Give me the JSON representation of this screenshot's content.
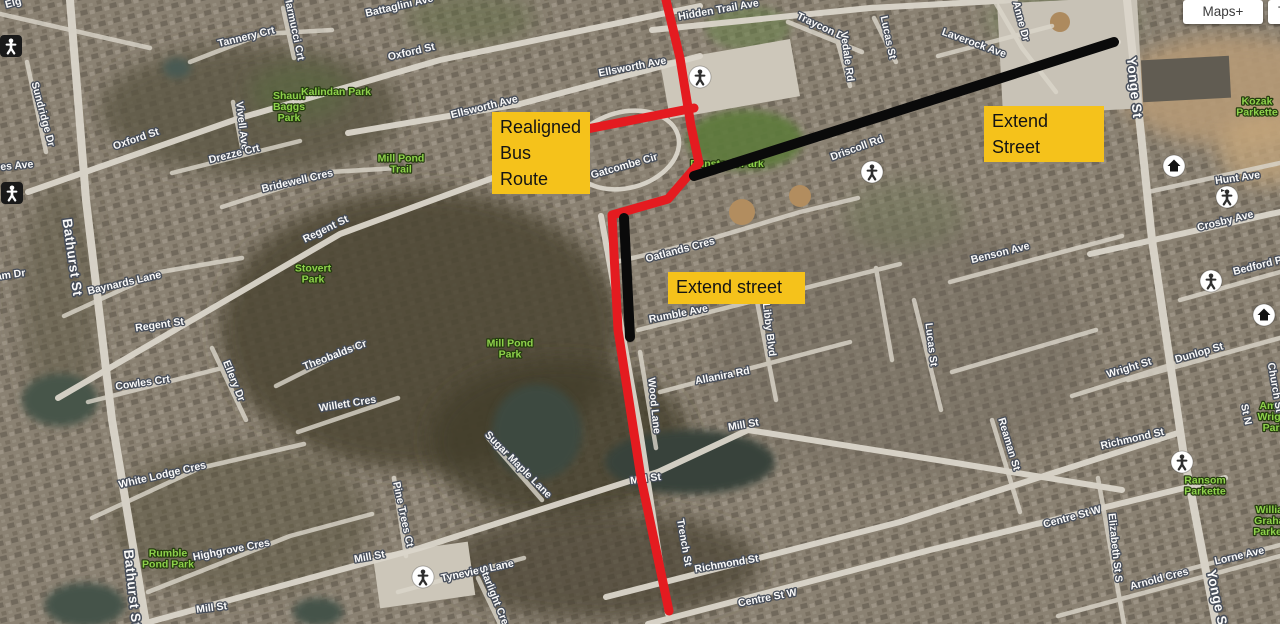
{
  "toolbar": {
    "maps_label": "Maps+",
    "tools_label": "To"
  },
  "annotations": {
    "box_color": "#f5c21b",
    "routes": [
      {
        "name": "realigned-bus-route-line",
        "color": "#e41b20",
        "width": 9,
        "points": [
          [
            666,
            0
          ],
          [
            680,
            58
          ],
          [
            691,
            126
          ],
          [
            699,
            163
          ],
          [
            668,
            199
          ],
          [
            612,
            215
          ],
          [
            618,
            330
          ],
          [
            641,
            478
          ],
          [
            669,
            611
          ]
        ]
      },
      {
        "name": "realigned-bus-route-spur",
        "color": "#e41b20",
        "width": 9,
        "points": [
          [
            587,
            129
          ],
          [
            694,
            108
          ]
        ]
      },
      {
        "name": "extend-street-line-east",
        "color": "#0a0a0a",
        "width": 10,
        "points": [
          [
            694,
            176
          ],
          [
            1114,
            42
          ]
        ]
      },
      {
        "name": "extend-street-line-south",
        "color": "#0a0a0a",
        "width": 10,
        "points": [
          [
            624,
            218
          ],
          [
            630,
            337
          ]
        ]
      }
    ],
    "boxes": [
      {
        "name": "realigned-bus-route-label",
        "text": "Realigned\nBus Route",
        "x": 492,
        "y": 112,
        "w": 98,
        "h": 54
      },
      {
        "name": "extend-street-label-north",
        "text": "Extend Street",
        "x": 984,
        "y": 106,
        "w": 120,
        "h": 31
      },
      {
        "name": "extend-street-label-south",
        "text": "Extend street",
        "x": 668,
        "y": 272,
        "w": 137,
        "h": 32
      }
    ]
  },
  "map": {
    "labels": [
      {
        "name": "label-elg-fragment",
        "text": "Elg",
        "x": 14,
        "y": 6,
        "rot": -15,
        "kind": "street"
      },
      {
        "name": "label-battaglini-ave",
        "text": "Battaglini Ave",
        "x": 400,
        "y": 9,
        "rot": -13,
        "kind": "street"
      },
      {
        "name": "label-tannery-crt",
        "text": "Tannery Crt",
        "x": 247,
        "y": 40,
        "rot": -14,
        "kind": "street"
      },
      {
        "name": "label-marmucci-crt",
        "text": "Marmucci Crt",
        "x": 291,
        "y": 28,
        "rot": 78,
        "kind": "street"
      },
      {
        "name": "label-oxford-st-west",
        "text": "Oxford St",
        "x": 137,
        "y": 142,
        "rot": -19,
        "kind": "street"
      },
      {
        "name": "label-oxford-st-east",
        "text": "Oxford St",
        "x": 412,
        "y": 55,
        "rot": -13,
        "kind": "street"
      },
      {
        "name": "label-sundridge-dr",
        "text": "Sundridge Dr",
        "x": 40,
        "y": 115,
        "rot": 75,
        "kind": "street"
      },
      {
        "name": "label-res-ave-fragment",
        "text": "res Ave",
        "x": 15,
        "y": 169,
        "rot": -5,
        "kind": "street"
      },
      {
        "name": "label-bathurst-st-north",
        "text": "Bathurst St",
        "x": 68,
        "y": 258,
        "rot": 82,
        "kind": "big"
      },
      {
        "name": "label-bathurst-st-south",
        "text": "Bathurst St",
        "x": 128,
        "y": 589,
        "rot": 84,
        "kind": "big"
      },
      {
        "name": "label-am-dr-fragment",
        "text": "am Dr",
        "x": 11,
        "y": 278,
        "rot": -8,
        "kind": "street"
      },
      {
        "name": "label-vivell-ave",
        "text": "Vivell Ave",
        "x": 239,
        "y": 126,
        "rot": 83,
        "kind": "street"
      },
      {
        "name": "label-drezze-crt",
        "text": "Drezze Crt",
        "x": 235,
        "y": 157,
        "rot": -14,
        "kind": "street"
      },
      {
        "name": "label-bridewell-cres",
        "text": "Bridewell Cres",
        "x": 298,
        "y": 184,
        "rot": -13,
        "kind": "street"
      },
      {
        "name": "label-shaun-baggs-park",
        "text": "Shaun\nBaggs\nPark",
        "x": 289,
        "y": 110,
        "rot": 0,
        "kind": "park"
      },
      {
        "name": "label-kalindan-park",
        "text": "Kalindan Park",
        "x": 336,
        "y": 95,
        "rot": 0,
        "kind": "park"
      },
      {
        "name": "label-mill-pond-trail",
        "text": "Mill Pond\nTrail",
        "x": 401,
        "y": 167,
        "rot": 0,
        "kind": "park"
      },
      {
        "name": "label-ellsworth-ave-east",
        "text": "Ellsworth Ave",
        "x": 633,
        "y": 70,
        "rot": -11,
        "kind": "street"
      },
      {
        "name": "label-ellsworth-ave-west",
        "text": "Ellsworth Ave",
        "x": 485,
        "y": 110,
        "rot": -14,
        "kind": "street"
      },
      {
        "name": "label-hidden-trail-ave",
        "text": "Hidden Trail Ave",
        "x": 719,
        "y": 13,
        "rot": -10,
        "kind": "street"
      },
      {
        "name": "label-traycon-dr",
        "text": "Traycon Dr",
        "x": 821,
        "y": 30,
        "rot": 25,
        "kind": "street"
      },
      {
        "name": "label-vedale-rd",
        "text": "Vedale Rd",
        "x": 844,
        "y": 57,
        "rot": 82,
        "kind": "street"
      },
      {
        "name": "label-lucas-st-north",
        "text": "Lucas St",
        "x": 885,
        "y": 38,
        "rot": 78,
        "kind": "street"
      },
      {
        "name": "label-laverock-ave",
        "text": "Laverock Ave",
        "x": 973,
        "y": 46,
        "rot": 20,
        "kind": "street"
      },
      {
        "name": "label-anne-dr",
        "text": "Anne Dr",
        "x": 1018,
        "y": 22,
        "rot": 75,
        "kind": "street"
      },
      {
        "name": "label-yonge-st-north",
        "text": "Yonge St",
        "x": 1130,
        "y": 88,
        "rot": 84,
        "kind": "big"
      },
      {
        "name": "label-yonge-st-south",
        "text": "Yonge St",
        "x": 1213,
        "y": 601,
        "rot": 78,
        "kind": "big"
      },
      {
        "name": "label-kozak-parkette",
        "text": "Kozak\nParkette",
        "x": 1257,
        "y": 110,
        "rot": 0,
        "kind": "park"
      },
      {
        "name": "label-hunt-ave",
        "text": "Hunt Ave",
        "x": 1238,
        "y": 181,
        "rot": -8,
        "kind": "street"
      },
      {
        "name": "label-crosby-ave",
        "text": "Crosby Ave",
        "x": 1226,
        "y": 224,
        "rot": -14,
        "kind": "street"
      },
      {
        "name": "label-bedford-park",
        "text": "Bedford Park",
        "x": 1266,
        "y": 267,
        "rot": -14,
        "kind": "street"
      },
      {
        "name": "label-benson-ave",
        "text": "Benson Ave",
        "x": 1001,
        "y": 256,
        "rot": -14,
        "kind": "street"
      },
      {
        "name": "label-driscoll-rd",
        "text": "Driscoll Rd",
        "x": 858,
        "y": 151,
        "rot": -20,
        "kind": "street"
      },
      {
        "name": "label-gatcombe-cir",
        "text": "Gatcombe Cir",
        "x": 625,
        "y": 169,
        "rot": -16,
        "kind": "street"
      },
      {
        "name": "label-dunstock-park",
        "text": "Dunstock Park",
        "x": 727,
        "y": 167,
        "rot": 0,
        "kind": "park"
      },
      {
        "name": "label-oatlands-cres",
        "text": "Oatlands Cres",
        "x": 681,
        "y": 253,
        "rot": -15,
        "kind": "street"
      },
      {
        "name": "label-rumble-ave",
        "text": "Rumble Ave",
        "x": 679,
        "y": 317,
        "rot": -11,
        "kind": "street"
      },
      {
        "name": "label-allanira-rd",
        "text": "Allanira Rd",
        "x": 723,
        "y": 379,
        "rot": -11,
        "kind": "street"
      },
      {
        "name": "label-libby-blvd",
        "text": "Libby Blvd",
        "x": 766,
        "y": 330,
        "rot": 83,
        "kind": "street"
      },
      {
        "name": "label-lucas-st-south",
        "text": "Lucas St",
        "x": 928,
        "y": 345,
        "rot": 83,
        "kind": "street"
      },
      {
        "name": "label-mill-st-center",
        "text": "Mill St",
        "x": 744,
        "y": 428,
        "rot": -10,
        "kind": "street"
      },
      {
        "name": "label-mill-st-west",
        "text": "Mill St",
        "x": 370,
        "y": 560,
        "rot": -10,
        "kind": "street"
      },
      {
        "name": "label-mill-st-southwest",
        "text": "Mill St",
        "x": 212,
        "y": 611,
        "rot": -7,
        "kind": "street"
      },
      {
        "name": "label-mill-st-pond",
        "text": "Mill St",
        "x": 646,
        "y": 482,
        "rot": -8,
        "kind": "street"
      },
      {
        "name": "label-wood-lane",
        "text": "Wood Lane",
        "x": 651,
        "y": 406,
        "rot": 84,
        "kind": "street"
      },
      {
        "name": "label-richmond-st-west",
        "text": "Richmond St",
        "x": 727,
        "y": 567,
        "rot": -10,
        "kind": "street"
      },
      {
        "name": "label-richmond-st-east",
        "text": "Richmond St",
        "x": 1133,
        "y": 442,
        "rot": -13,
        "kind": "street"
      },
      {
        "name": "label-centre-st-w-west",
        "text": "Centre St W",
        "x": 768,
        "y": 601,
        "rot": -11,
        "kind": "street"
      },
      {
        "name": "label-centre-st-w-east",
        "text": "Centre St W",
        "x": 1073,
        "y": 520,
        "rot": -15,
        "kind": "street"
      },
      {
        "name": "label-trench-st",
        "text": "Trench St",
        "x": 681,
        "y": 543,
        "rot": 80,
        "kind": "street"
      },
      {
        "name": "label-elizabeth-st-s",
        "text": "Elizabeth St S",
        "x": 1112,
        "y": 548,
        "rot": 84,
        "kind": "street"
      },
      {
        "name": "label-reaman-st",
        "text": "Reaman St",
        "x": 1006,
        "y": 445,
        "rot": 73,
        "kind": "street"
      },
      {
        "name": "label-arnold-cres",
        "text": "Arnold Cres",
        "x": 1160,
        "y": 582,
        "rot": -15,
        "kind": "street"
      },
      {
        "name": "label-lorne-ave",
        "text": "Lorne Ave",
        "x": 1240,
        "y": 559,
        "rot": -13,
        "kind": "street"
      },
      {
        "name": "label-ransom-parkette",
        "text": "Ransom\nParkette",
        "x": 1205,
        "y": 489,
        "rot": 0,
        "kind": "park"
      },
      {
        "name": "label-william-graham-parkette",
        "text": "William\nGraham\nParkette",
        "x": 1274,
        "y": 524,
        "rot": 0,
        "kind": "park"
      },
      {
        "name": "label-amos-wright-park",
        "text": "Amos\nWright\nPark",
        "x": 1274,
        "y": 420,
        "rot": 0,
        "kind": "park"
      },
      {
        "name": "label-church-st",
        "text": "Church St",
        "x": 1272,
        "y": 388,
        "rot": 80,
        "kind": "street"
      },
      {
        "name": "label-dunlop-st",
        "text": "Dunlop St",
        "x": 1200,
        "y": 356,
        "rot": -16,
        "kind": "street"
      },
      {
        "name": "label-wright-st",
        "text": "Wright St",
        "x": 1130,
        "y": 371,
        "rot": -17,
        "kind": "street"
      },
      {
        "name": "label-white-lodge-cres",
        "text": "White Lodge Cres",
        "x": 163,
        "y": 478,
        "rot": -13,
        "kind": "street"
      },
      {
        "name": "label-highgrove-cres",
        "text": "Highgrove Cres",
        "x": 232,
        "y": 553,
        "rot": -11,
        "kind": "street"
      },
      {
        "name": "label-rumble-pond-park",
        "text": "Rumble\nPond Park",
        "x": 168,
        "y": 562,
        "rot": 0,
        "kind": "park"
      },
      {
        "name": "label-willett-cres",
        "text": "Willett Cres",
        "x": 348,
        "y": 407,
        "rot": -9,
        "kind": "street"
      },
      {
        "name": "label-pine-trees-ct",
        "text": "Pine Trees Ct",
        "x": 400,
        "y": 515,
        "rot": 78,
        "kind": "street"
      },
      {
        "name": "label-sugar-maple-lane",
        "text": "Sugar Maple Lane",
        "x": 516,
        "y": 467,
        "rot": 45,
        "kind": "street"
      },
      {
        "name": "label-tyneview-lane",
        "text": "Tyneview Lane",
        "x": 478,
        "y": 574,
        "rot": -12,
        "kind": "street"
      },
      {
        "name": "label-starlight-cres",
        "text": "Starlight Cres",
        "x": 492,
        "y": 599,
        "rot": 68,
        "kind": "street"
      },
      {
        "name": "label-cowles-crt",
        "text": "Cowles Crt",
        "x": 143,
        "y": 386,
        "rot": -8,
        "kind": "street"
      },
      {
        "name": "label-ellery-dr",
        "text": "Ellery Dr",
        "x": 231,
        "y": 382,
        "rot": 68,
        "kind": "street"
      },
      {
        "name": "label-theobalds-cr",
        "text": "Theobalds Cr",
        "x": 336,
        "y": 358,
        "rot": -21,
        "kind": "street"
      },
      {
        "name": "label-baynards-lane",
        "text": "Baynards Lane",
        "x": 125,
        "y": 286,
        "rot": -13,
        "kind": "street"
      },
      {
        "name": "label-regent-st-west",
        "text": "Regent St",
        "x": 160,
        "y": 328,
        "rot": -8,
        "kind": "street"
      },
      {
        "name": "label-regent-st-east",
        "text": "Regent St",
        "x": 327,
        "y": 232,
        "rot": -26,
        "kind": "street"
      },
      {
        "name": "label-stovert-park",
        "text": "Stovert\nPark",
        "x": 313,
        "y": 277,
        "rot": 0,
        "kind": "park"
      },
      {
        "name": "label-mill-pond-park",
        "text": "Mill Pond\nPark",
        "x": 510,
        "y": 352,
        "rot": 0,
        "kind": "park"
      },
      {
        "name": "label-st-n-fragment",
        "text": "St N",
        "x": 1243,
        "y": 415,
        "rot": 78,
        "kind": "street"
      }
    ],
    "icons": [
      {
        "name": "pedestrian-square-icon",
        "type": "ped-square",
        "x": 11,
        "y": 46
      },
      {
        "name": "pedestrian-square-icon",
        "type": "ped-square",
        "x": 12,
        "y": 193
      },
      {
        "name": "pedestrian-circle-icon",
        "type": "ped-circle",
        "x": 700,
        "y": 77
      },
      {
        "name": "pedestrian-circle-icon",
        "type": "ped-circle",
        "x": 872,
        "y": 172
      },
      {
        "name": "pedestrian-flag-circle-icon",
        "type": "ped-flag-circle",
        "x": 1227,
        "y": 197
      },
      {
        "name": "pedestrian-circle-icon",
        "type": "ped-circle",
        "x": 1211,
        "y": 281
      },
      {
        "name": "home-circle-icon",
        "type": "home-circle",
        "x": 1174,
        "y": 166
      },
      {
        "name": "home-circle-icon",
        "type": "home-circle",
        "x": 1264,
        "y": 315
      },
      {
        "name": "pedestrian-circle-icon",
        "type": "ped-circle",
        "x": 423,
        "y": 577
      },
      {
        "name": "pedestrian-circle-icon",
        "type": "ped-circle",
        "x": 1182,
        "y": 462
      }
    ]
  }
}
